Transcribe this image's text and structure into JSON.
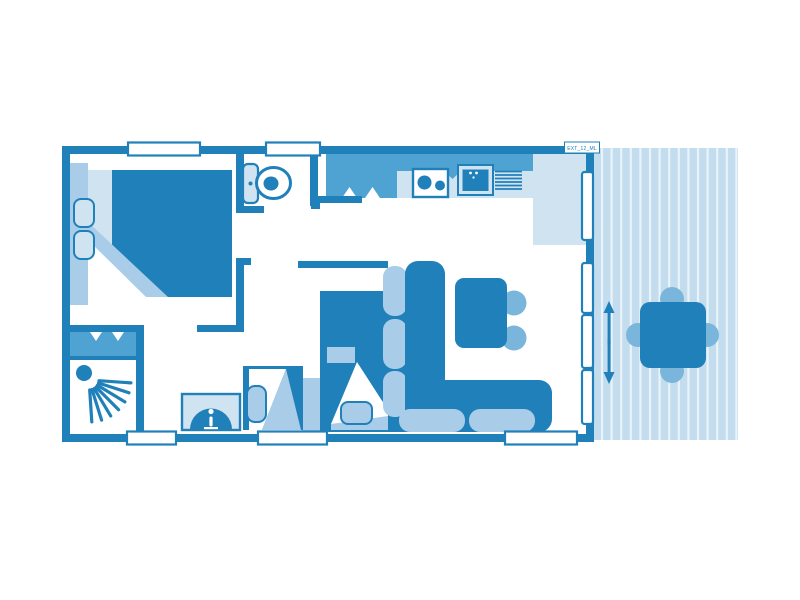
{
  "plan": {
    "label": "EXT_12_ML",
    "palette": {
      "dark_blue": "#2080ba",
      "medium_blue": "#4fa3d2",
      "soft_blue": "#7ab5db",
      "light_blue": "#a9cde8",
      "pale_blue": "#cfe3f1",
      "terrace_blue": "#c3dcee",
      "terrace_stripe": "#e9f3fa",
      "background": "#ffffff"
    }
  }
}
